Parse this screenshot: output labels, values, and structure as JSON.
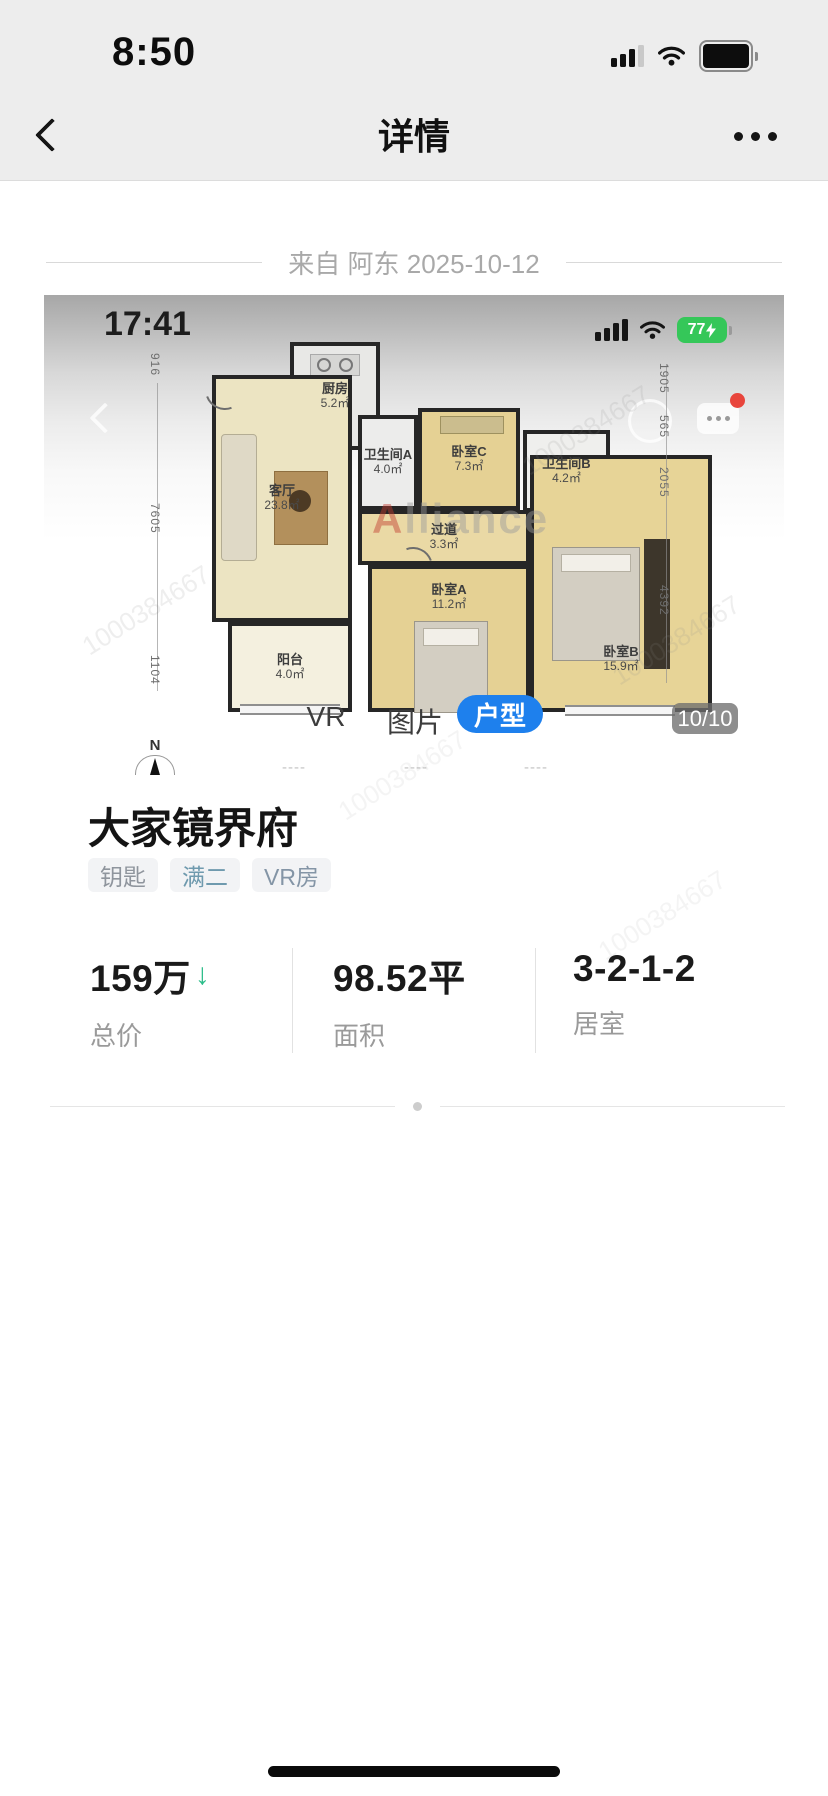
{
  "status_bar": {
    "time": "8:50"
  },
  "nav": {
    "title": "详情"
  },
  "source_line": {
    "text": "来自 阿东 2025-10-12"
  },
  "photo": {
    "inner_status": {
      "time": "17:41",
      "battery_percent": "77"
    },
    "floorplan": {
      "watermark_prefix": "A",
      "watermark_suffix": "lliance",
      "watermark_number": "1000384667",
      "compass": "N",
      "rooms": [
        {
          "name": "厨房",
          "area": "5.2㎡"
        },
        {
          "name": "卫生间A",
          "area": "4.0㎡"
        },
        {
          "name": "卧室C",
          "area": "7.3㎡"
        },
        {
          "name": "卫生间B",
          "area": "4.2㎡"
        },
        {
          "name": "客厅",
          "area": "23.8㎡"
        },
        {
          "name": "过道",
          "area": "3.3㎡"
        },
        {
          "name": "卧室A",
          "area": "11.2㎡"
        },
        {
          "name": "卧室B",
          "area": "15.9㎡"
        },
        {
          "name": "阳台",
          "area": "4.0㎡"
        }
      ],
      "dims_left": [
        "916",
        "7605",
        "1104"
      ],
      "dims_right": [
        "1905",
        "565",
        "2055",
        "4392"
      ],
      "floor_dashes": [
        "----",
        "----",
        "----"
      ]
    },
    "tabs": [
      {
        "label": "VR"
      },
      {
        "label": "图片"
      },
      {
        "label": "户型",
        "active": true
      }
    ],
    "counter": "10/10"
  },
  "listing": {
    "title": "大家镜界府",
    "tags": [
      "钥匙",
      "满二",
      "VR房"
    ],
    "stats": [
      {
        "value": "159万",
        "arrow": "↓",
        "label": "总价"
      },
      {
        "value": "98.52平",
        "label": "面积"
      },
      {
        "value": "3-2-1-2",
        "label": "居室"
      }
    ]
  },
  "icons": [
    "signal-icon",
    "wifi-icon",
    "battery-icon",
    "back-icon",
    "more-icon",
    "chat-overlay-icon",
    "circle-overlay-icon",
    "compass-icon",
    "stove-icon",
    "home-indicator"
  ],
  "colors": {
    "accent_blue": "#1e80ed",
    "battery_green": "#35c759",
    "arrow_green": "#2dbd8a",
    "notification_red": "#e8453c",
    "tag_bg": "#f2f3f5"
  }
}
